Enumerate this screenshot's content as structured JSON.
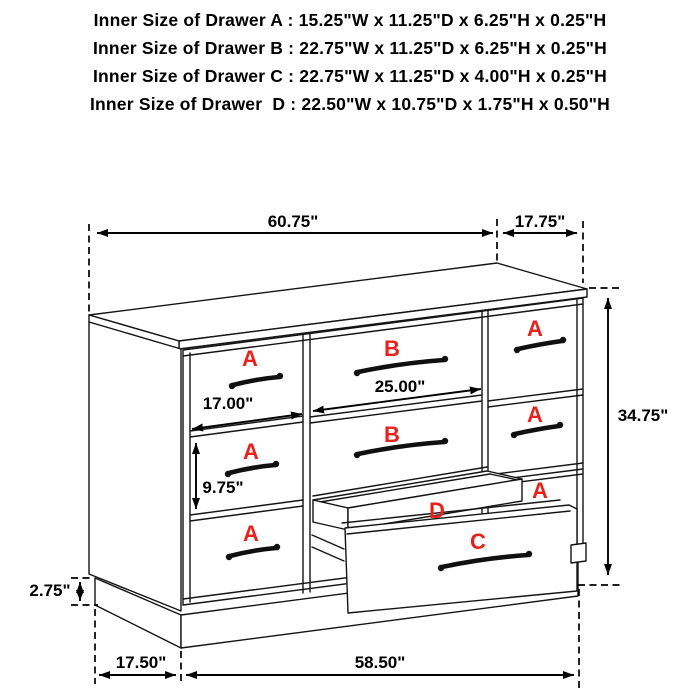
{
  "header": {
    "lines": [
      "Inner Size of Drawer A : 15.25\"W x 11.25\"D x 6.25\"H x 0.25\"H",
      "Inner Size of Drawer B : 22.75\"W x 11.25\"D x 6.25\"H x 0.25\"H",
      "Inner Size of Drawer C : 22.75\"W x 11.25\"D x 4.00\"H x 0.25\"H",
      "Inner Size of Drawer  D : 22.50\"W x 10.75\"D x 1.75\"H x 0.50\"H"
    ]
  },
  "diagram": {
    "label_color": "#e8211d",
    "dimensions": {
      "overall_width": "60.75\"",
      "overall_depth": "17.75\"",
      "overall_height": "34.75\"",
      "small_drawer_width": "17.00\"",
      "large_drawer_width": "25.00\"",
      "lower_section_height": "9.75\"",
      "base_height": "2.75\"",
      "base_side_depth": "17.50\"",
      "base_front_width": "58.50\""
    },
    "labels": {
      "a1_left": "A",
      "a2_left": "A",
      "a3_left": "A",
      "b1": "B",
      "b2": "B",
      "a1_right": "A",
      "a2_right": "A",
      "a3_right": "A",
      "c": "C",
      "d": "D"
    }
  }
}
